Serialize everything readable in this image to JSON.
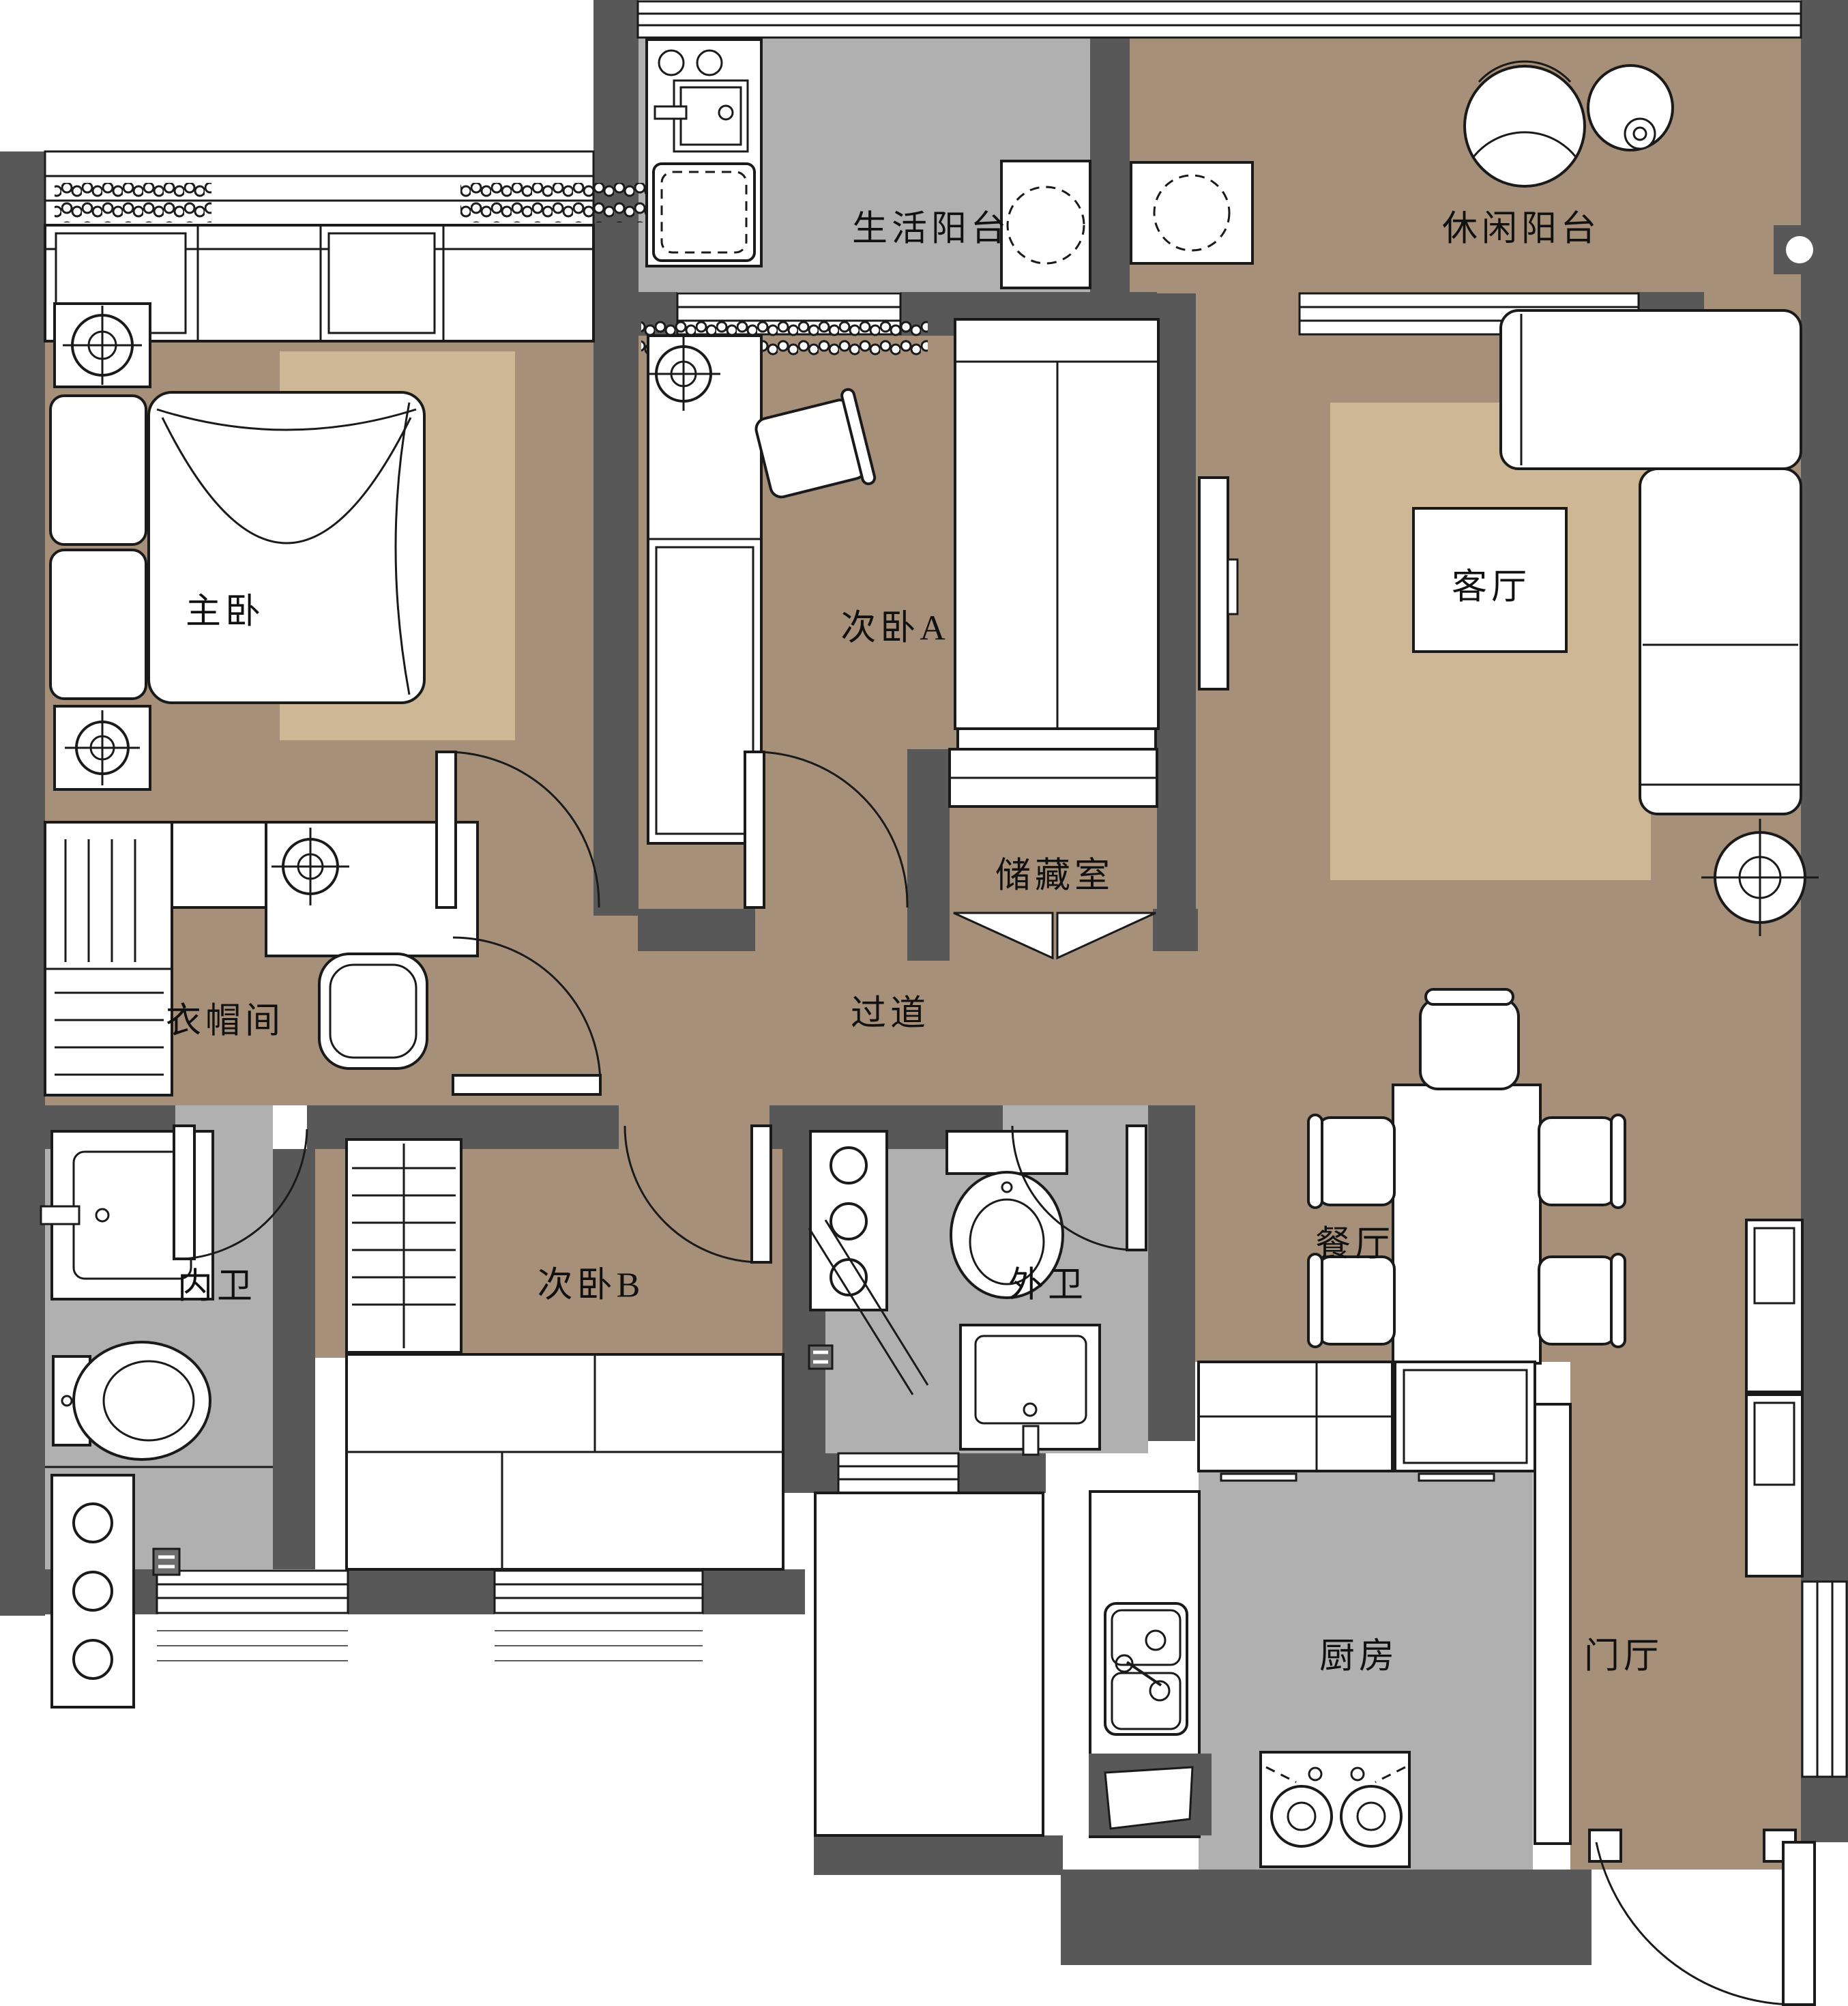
{
  "title": "三室两厅户型平面布置图",
  "colors": {
    "wall": "#585858",
    "floor_brown": "#a6907a",
    "rug_tan": "#cdb795",
    "floor_gray": "#b0b0b0",
    "line": "#1a1a1a"
  },
  "rooms": {
    "utility_balcony": {
      "label": "生活阳台"
    },
    "leisure_balcony": {
      "label": "休闲阳台"
    },
    "master_bedroom": {
      "label": "主卧"
    },
    "bedroom_a": {
      "label": "次卧A"
    },
    "living_room": {
      "label": "客厅"
    },
    "storage": {
      "label": "储藏室"
    },
    "hallway": {
      "label": "过道"
    },
    "cloakroom": {
      "label": "衣帽间"
    },
    "inner_bathroom": {
      "label": "内卫"
    },
    "bedroom_b": {
      "label": "次卧B"
    },
    "outer_bathroom": {
      "label": "外卫"
    },
    "dining_room": {
      "label": "餐厅"
    },
    "kitchen": {
      "label": "厨房"
    },
    "entry_hall": {
      "label": "门厅"
    }
  }
}
